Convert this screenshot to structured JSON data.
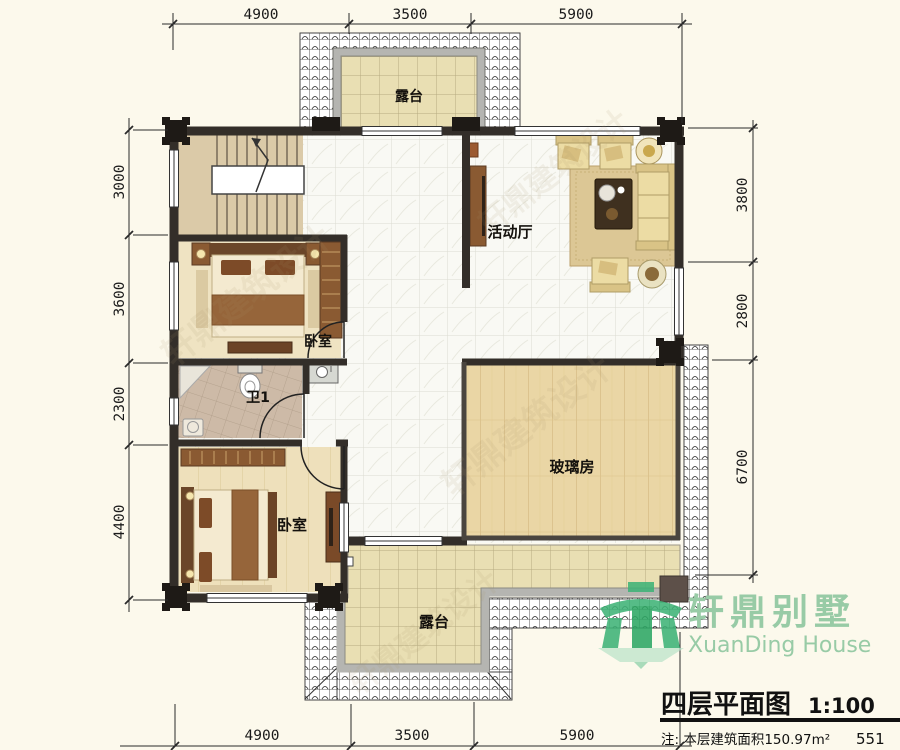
{
  "drawing": {
    "title": "四层平面图",
    "scale": "1:100",
    "note": "注: 本层建筑面积150.97m²",
    "sheet_number": "551"
  },
  "logo": {
    "name_cn": "轩鼎别墅",
    "name_en": "XuanDing House",
    "color": "#98cba6",
    "icon": "house-gate-icon"
  },
  "rooms": {
    "terrace_top": "露台",
    "activity_hall": "活动厅",
    "bedroom_upper": "卧室",
    "bathroom": "卫1",
    "bedroom_lower": "卧室",
    "glass_room": "玻璃房",
    "terrace_bottom": "露台"
  },
  "dimensions": {
    "top": [
      "4900",
      "3500",
      "5900"
    ],
    "bottom": [
      "4900",
      "3500",
      "5900"
    ],
    "left": [
      "3000",
      "3600",
      "2300",
      "4400"
    ],
    "right": [
      "3800",
      "2800",
      "6700"
    ]
  },
  "watermark": "轩鼎建筑设计",
  "colors": {
    "wall": "#332e29",
    "terrace_tile": "#e9dfb3",
    "wood_floor": "#ead6a5",
    "logo_green": "#3fb377",
    "background": "#fcf9ec"
  }
}
